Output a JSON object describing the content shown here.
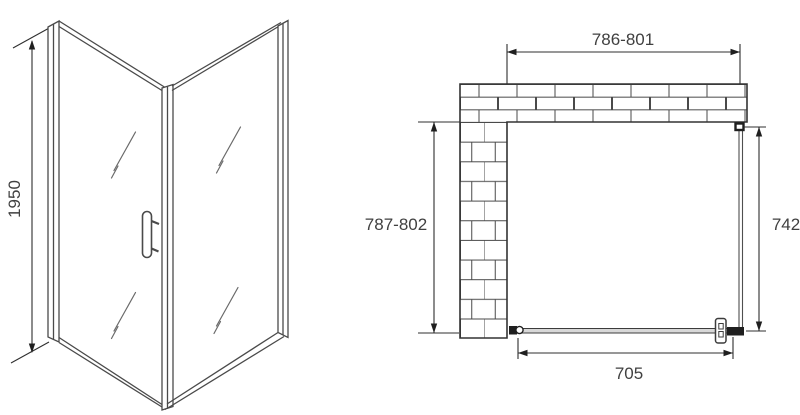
{
  "front_view": {
    "height_label": "1950"
  },
  "plan_view": {
    "top_width_label": "786-801",
    "left_depth_label": "787-802",
    "right_glass_label": "742",
    "door_width_label": "705"
  },
  "colors": {
    "background": "#ffffff",
    "line": "#3f3f3f",
    "text": "#404040",
    "glass_fill": "#d8d8d8",
    "profile_dark": "#1f1f1f"
  }
}
